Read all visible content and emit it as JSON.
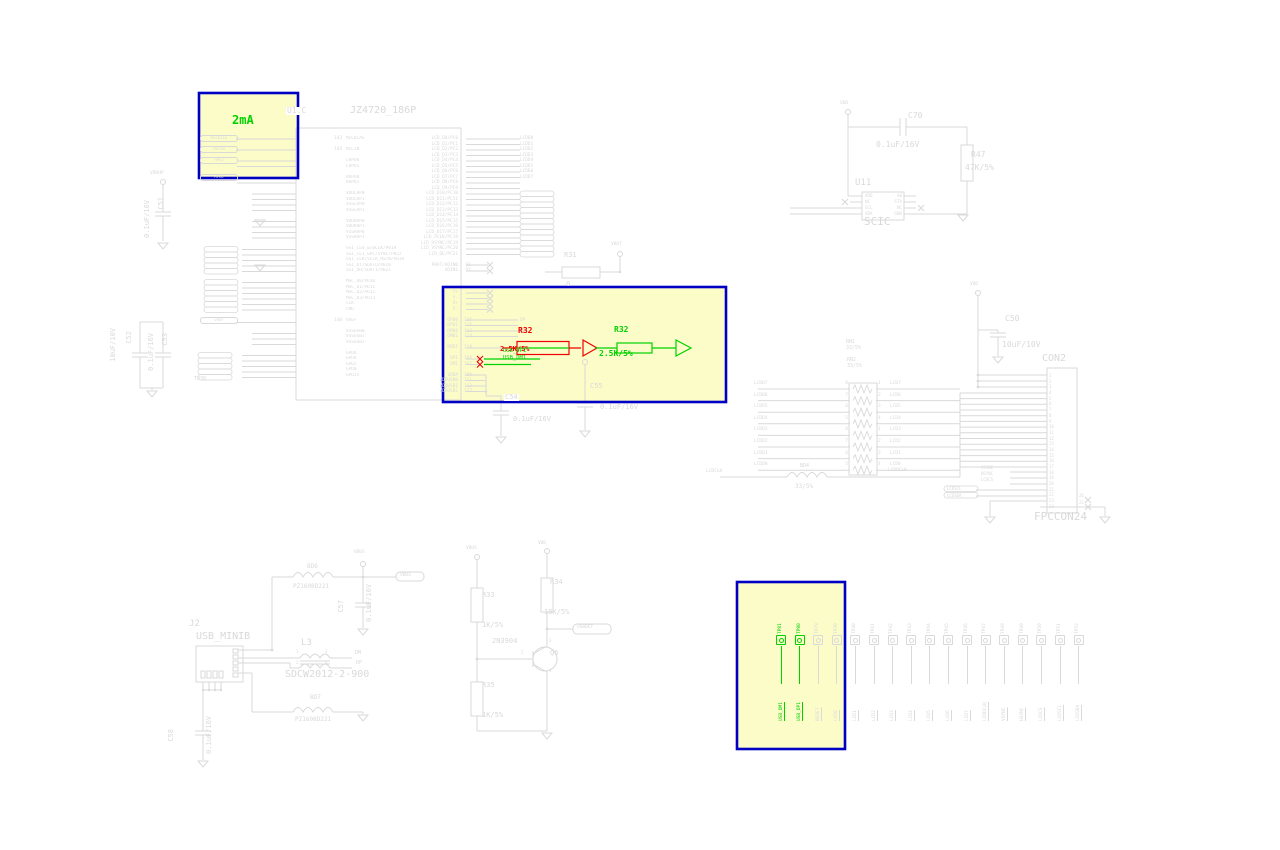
{
  "colors": {
    "ghost": "#d9d9d9",
    "added_green": "#00d200",
    "removed_red": "#ee0000",
    "box_fill": "#fcfcc8",
    "box_border": "#0000c4",
    "canvas": "#ffffff"
  },
  "ic": {
    "refdes": "U1.C",
    "part": "JZ4720_186P",
    "left_pins": [
      {
        "flag": "MICBIAS",
        "name": "MICBIAS",
        "num": "143"
      },
      {},
      {
        "flag": "MICIN",
        "name": "MICIN",
        "num": "144"
      },
      {},
      {
        "flag": "HPLO",
        "name": "LHPO0",
        "num": ""
      },
      {
        "name": "LHPO1"
      },
      {},
      {
        "flag": "HPRO",
        "name": "RHPO0",
        "num": ""
      },
      {
        "name": "RHPO1"
      },
      {},
      {
        "name": "VDDLHP0"
      },
      {
        "name": "VDDLHP1"
      },
      {
        "name": "VSSLHP0"
      },
      {
        "name": "VSSLHP1"
      },
      {},
      {
        "name": "VDDRHP0"
      },
      {
        "name": "VDDRHP1"
      },
      {
        "name": "VSSRHP0"
      },
      {
        "name": "VSSRHP1"
      },
      {},
      {
        "name": "SSI_CE0_&/BCLK/PB19"
      },
      {
        "name": "SSI_CE1_GPC/SYNC/PB22"
      },
      {
        "name": "SSI_CLK/SCLK_RSTN/PB18"
      },
      {
        "name": "SSI_DT/SDATO/PB20"
      },
      {
        "name": "SSI_DR/SDATI/PB21"
      },
      {},
      {
        "name": "MSC_D0/PD10"
      },
      {
        "name": "MSC_D1/PD11"
      },
      {
        "name": "MSC_D2/PD12"
      },
      {
        "name": "MSC_D3/PD13"
      },
      {
        "name": "CLK"
      },
      {
        "name": "CMD"
      },
      {},
      {
        "flag": "VREF",
        "name": "VREF",
        "num": "140"
      },
      {},
      {
        "name": "VSSUSB0"
      },
      {
        "name": "VSSUSB1"
      },
      {
        "name": "VSSUSB2"
      },
      {},
      {
        "name": "GPD6"
      },
      {
        "name": "GPD4"
      },
      {
        "name": "GPD2"
      },
      {
        "name": "GPD0"
      },
      {
        "name": "GPD15"
      }
    ],
    "right_pins": [
      {
        "name": "LCD_D0/PC0",
        "net": "LCDD0"
      },
      {
        "name": "LCD_D1/PC1",
        "net": "LCDD1"
      },
      {
        "name": "LCD_D2/PC2",
        "net": "LCDD2"
      },
      {
        "name": "LCD_D3/PC3",
        "net": "LCDD3"
      },
      {
        "name": "LCD_D4/PC4",
        "net": "LCDD4"
      },
      {
        "name": "LCD_D5/PC5",
        "net": "LCDD5"
      },
      {
        "name": "LCD_D6/PC6",
        "net": "LCDD6"
      },
      {
        "name": "LCD_D7/PC7",
        "net": "LCDD7"
      },
      {
        "name": "LCD_D8/PC8"
      },
      {
        "name": "LCD_D9/PC9"
      },
      {
        "name": "LCD_D10/PC10"
      },
      {
        "name": "LCD_D11/PC11"
      },
      {
        "name": "LCD_D12/PC12"
      },
      {
        "name": "LCD_D13/PC13"
      },
      {
        "name": "LCD_D14/PC14"
      },
      {
        "name": "LCD_D15/PC15"
      },
      {
        "name": "LCD_D16/PC16"
      },
      {
        "name": "LCD_D17/PC17"
      },
      {
        "name": "LCD_PCLK/PC18"
      },
      {
        "name": "LCD_HSYNC/PC19"
      },
      {
        "name": "LCD_VSYNC/PC20"
      },
      {
        "name": "LCD_DE/PC21"
      },
      {},
      {
        "name": "PBAT/ADIN0",
        "num": "92"
      },
      {
        "name": "ADIN1",
        "num": "93"
      },
      {},
      {},
      {},
      {
        "name": "Y+"
      },
      {
        "name": "Y-"
      },
      {
        "name": "X+"
      },
      {
        "name": "X-"
      },
      {},
      {
        "name": "DP00",
        "num": "115",
        "net": "DP"
      },
      {
        "name": "DP01",
        "num": "116"
      },
      {
        "name": "DM00",
        "num": "113",
        "net": "DM"
      },
      {
        "name": "DM01",
        "num": "114"
      },
      {},
      {
        "name": "RREF",
        "num": "110"
      },
      {},
      {
        "name": "DP1",
        "num": "106"
      },
      {
        "name": "DM1",
        "num": "107"
      },
      {},
      {
        "name": "VDDA",
        "num": "109"
      },
      {
        "name": "VDDUSB0",
        "num": "111"
      },
      {
        "name": "VDDUSB1",
        "num": "112"
      },
      {
        "name": "VDDUSB2",
        "num": "117"
      }
    ]
  },
  "highlight": {
    "current_label": "2mA",
    "removed": {
      "ref": "R32",
      "value": "2.5K/5%"
    },
    "added": {
      "ref": "R32",
      "value": "2.5K/5%"
    },
    "net1": "USB_DP1",
    "net2": "USB_DM1"
  },
  "testpoints": {
    "green": [
      {
        "ref": "TP81",
        "net": "USB_DM1"
      },
      {
        "ref": "TP80",
        "net": "USB_DP1"
      }
    ],
    "gray": [
      {
        "ref": "TP79",
        "net": "RESET"
      },
      {
        "ref": "TP39",
        "net": "LCD0"
      },
      {
        "ref": "TP40",
        "net": "LCD1"
      },
      {
        "ref": "TP41",
        "net": "LCD2"
      },
      {
        "ref": "TP42",
        "net": "LCD3"
      },
      {
        "ref": "TP43",
        "net": "LCD4"
      },
      {
        "ref": "TP44",
        "net": "LCD5"
      },
      {
        "ref": "TP45",
        "net": "LCD6"
      },
      {
        "ref": "TP46",
        "net": "LCD7"
      },
      {
        "ref": "TP47",
        "net": "LCDDCLK"
      },
      {
        "ref": "TP48",
        "net": "VSYNC"
      },
      {
        "ref": "TP49",
        "net": "HSYNC"
      },
      {
        "ref": "TP50",
        "net": "LCDCS"
      },
      {
        "ref": "TP51",
        "net": "LCDSCL"
      },
      {
        "ref": "TP52",
        "net": "LCDSDA"
      }
    ]
  },
  "components": {
    "r31": {
      "ref": "R31",
      "val": "0"
    },
    "r33": {
      "ref": "R33",
      "val": "1K/5%"
    },
    "r34": {
      "ref": "R34",
      "val": "10K/5%"
    },
    "r35": {
      "ref": "R35",
      "val": "1K/5%"
    },
    "r47": {
      "ref": "R47",
      "val": "47K/5%"
    },
    "c50": {
      "ref": "C50",
      "val": "10uF/10V"
    },
    "c51": {
      "ref": "C51",
      "val": "0.1uF/16V"
    },
    "c52": {
      "ref": "C52",
      "val": "10uF/10V"
    },
    "c53": {
      "ref": "C53",
      "val": "0.1uF/16V"
    },
    "c54": {
      "ref": "C54",
      "val": "0.1uF/16V"
    },
    "c55": {
      "ref": "C55",
      "val": "0.1uF/16V"
    },
    "c57": {
      "ref": "C57",
      "val": "0.1uF/16V"
    },
    "c58": {
      "ref": "C58",
      "val": "0.1uF/16V"
    },
    "c70": {
      "ref": "C70",
      "val": "0.1uF/16V"
    },
    "rn1": {
      "ref": "RN1",
      "val": "33/5%"
    },
    "rn2": {
      "ref": "RN2",
      "val": "33/5%"
    },
    "bd4": {
      "ref": "BD4",
      "val": "33/5%"
    },
    "bd6": {
      "ref": "BD6",
      "val": "PZ1608D221"
    },
    "bd7": {
      "ref": "BD7",
      "val": "PZ1608D221"
    },
    "l3": {
      "ref": "L3",
      "val": "SDCW2012-2-900"
    },
    "j2": {
      "ref": "J2",
      "val": "USB_MINIB"
    },
    "u11": {
      "ref": "U11",
      "val": "SCIC"
    },
    "q6": {
      "ref": "Q6",
      "val": "2N3904"
    },
    "con2": {
      "ref": "CON2",
      "val": "FPCCON24"
    }
  },
  "power": {
    "vbat": "VBAT",
    "vbus": "VBUS",
    "vdd": "VDD",
    "vddhp": "VDDHP"
  },
  "nets": {
    "dm": "DM",
    "dp": "DP",
    "lcdclk": "LCDCLK",
    "lcddclk": "LCDDCLK",
    "vsync": "VSYNC",
    "hsync": "HSYNC",
    "lcdcs": "LCDCS",
    "lcdscl": "LCDSCL",
    "lcdsda": "LCDSDA",
    "usbdet": "USBDET",
    "tp38": "TP38"
  },
  "u11_pins": {
    "left": [
      "VDD",
      "NC",
      "SCL",
      "SDA"
    ],
    "right": [
      "A0",
      "STA",
      "NC",
      "GND"
    ]
  },
  "rn_rows": [
    {
      "lnet": "LCDD7",
      "lnum": "8",
      "rnum": "1",
      "rnet": "LCD7"
    },
    {
      "lnet": "LCDD6",
      "lnum": "7",
      "rnum": "2",
      "rnet": "LCD6"
    },
    {
      "lnet": "LCDD5",
      "lnum": "6",
      "rnum": "3",
      "rnet": "LCD5"
    },
    {
      "lnet": "LCDD4",
      "lnum": "5",
      "rnum": "4",
      "rnet": "LCD4"
    },
    {
      "lnet": "LCDD3",
      "lnum": "8",
      "rnum": "1",
      "rnet": "LCD3"
    },
    {
      "lnet": "LCDD2",
      "lnum": "7",
      "rnum": "2",
      "rnet": "LCD2"
    },
    {
      "lnet": "LCDD1",
      "lnum": "6",
      "rnum": "3",
      "rnet": "LCD1"
    },
    {
      "lnet": "LCDD0",
      "lnum": "5",
      "rnum": "4",
      "rnet": "LCD0"
    }
  ],
  "con2_pins": [
    "1",
    "2",
    "3",
    "4",
    "5",
    "6",
    "7",
    "8",
    "9",
    "10",
    "11",
    "12",
    "13",
    "14",
    "15",
    "16",
    "17",
    "18",
    "19",
    "20",
    "21",
    "22",
    "23",
    "24"
  ],
  "con2_extra": [
    "26",
    "25"
  ],
  "l3_pins": [
    "1",
    "3",
    "2",
    "4"
  ],
  "q_pins": [
    "3",
    "2",
    "1"
  ]
}
